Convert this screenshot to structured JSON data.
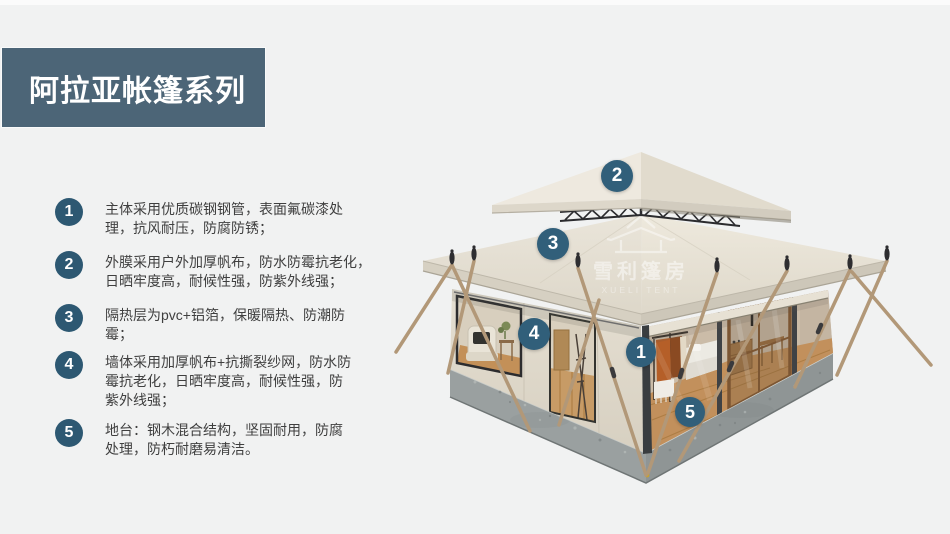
{
  "header": {
    "title": "阿拉亚帐篷系列"
  },
  "features": [
    {
      "num": "1",
      "text": [
        "主体采用优质碳钢钢管，表面氟碳漆处",
        "理，抗风耐压，防腐防锈；"
      ]
    },
    {
      "num": "2",
      "text": [
        "外膜采用户外加厚帆布，防水防霉抗老化，",
        "日晒牢度高，耐候性强，防紫外线强；"
      ]
    },
    {
      "num": "3",
      "text": [
        "隔热层为pvc+铝箔，保暖隔热、防潮防",
        "霉；"
      ]
    },
    {
      "num": "4",
      "text": [
        "墙体采用加厚帆布+抗撕裂纱网，防水防",
        "霉抗老化，日晒牢度高，耐候性强，防",
        "紫外线强；"
      ]
    },
    {
      "num": "5",
      "text": [
        "地台：钢木混合结构，坚固耐用，防腐",
        "处理，防朽耐磨易清洁。"
      ]
    }
  ],
  "callouts": [
    {
      "num": "1"
    },
    {
      "num": "2"
    },
    {
      "num": "3"
    },
    {
      "num": "4"
    },
    {
      "num": "5"
    }
  ],
  "watermark": {
    "cn": "雪利篷房",
    "en": "XUELI TENT"
  },
  "colors": {
    "background": "#F1F2F2",
    "banner": "#4C6577",
    "list_badge": "#2D5872",
    "callout_badge": "#315F7A",
    "roof_canvas": "#E7E2D6",
    "platform_gray": "#949A9A",
    "pole_wood": "#B29878"
  }
}
